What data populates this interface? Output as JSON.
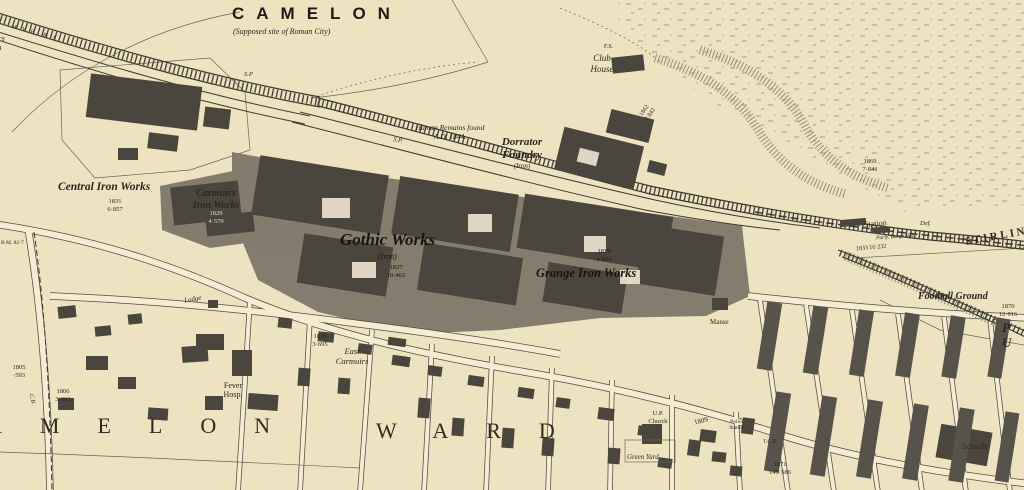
{
  "colors": {
    "paper": "#eee3c0",
    "ink": "#2b271f",
    "works_wash": "#7b7467",
    "building": "#4b463d",
    "road_fill": "#f5ecd2",
    "hatch": "#8a8371"
  },
  "labels": {
    "camelon": "CAMELON",
    "camelon_sub": "(Supposed site of Roman City)",
    "carmuirs_junction": "Carmuirs\nJunction",
    "railway_abbrev": "M.Y.B. & S.",
    "sp1": "S.P",
    "sp2": "S.P.",
    "bm_mark": "B.M. 82·7",
    "human_remains": "Human Remains found\nA.D. 1844.",
    "dorrator_foundry": "Dorrator\nFoundry",
    "dorrator_sub": "(Iron)",
    "club_house": "Club\nHouse",
    "fs_mark": "F.S.",
    "central_iron_works": "Central Iron Works",
    "central_nums": "1831\n6·857",
    "carmuirs_iron_works": "Carmuirs\nIron Works",
    "carmuirs_nums": "1829\n4·579",
    "gothic_works": "Gothic Works",
    "gothic_sub": "(Iron)",
    "gothic_nums": "1827\n10·462",
    "grange_nums": "1819\n4·836",
    "grange_iron_works": "Grange Iron Works",
    "nums_1862": "1862\n2·842",
    "nums_1869": "1869\n7·841",
    "station": "Station",
    "def_mark": "Def.",
    "parly_bdy": "Parly. Burgh Bdy.",
    "rail_nums": "1833   16·232",
    "stirlings": "STIRLINGS",
    "football_ground": "Football Ground",
    "football_nums": "1870\n12·916",
    "pu_partial": "P U",
    "nums_1805": "1805\n·593",
    "cb_mark": "C.B.",
    "nums_1806": "1806\n3·002",
    "ward_amelon": "AMELON",
    "ward_ward": "WARD",
    "lodge": "Lodge",
    "nums_1838": "1838\n3·695",
    "east_carmuirs": "East\nCarmuirs",
    "fever_hosp": "Fever\nHosp.",
    "manse": "Manse",
    "up_church": "U.P.\nChurch",
    "green_yard": "Green Yard",
    "police_station": "Police\nStation",
    "nums_1809": "1809",
    "tcb_mark": "T.C.B.",
    "nums_1871": "1871\n149·586",
    "schools": "Schools"
  }
}
